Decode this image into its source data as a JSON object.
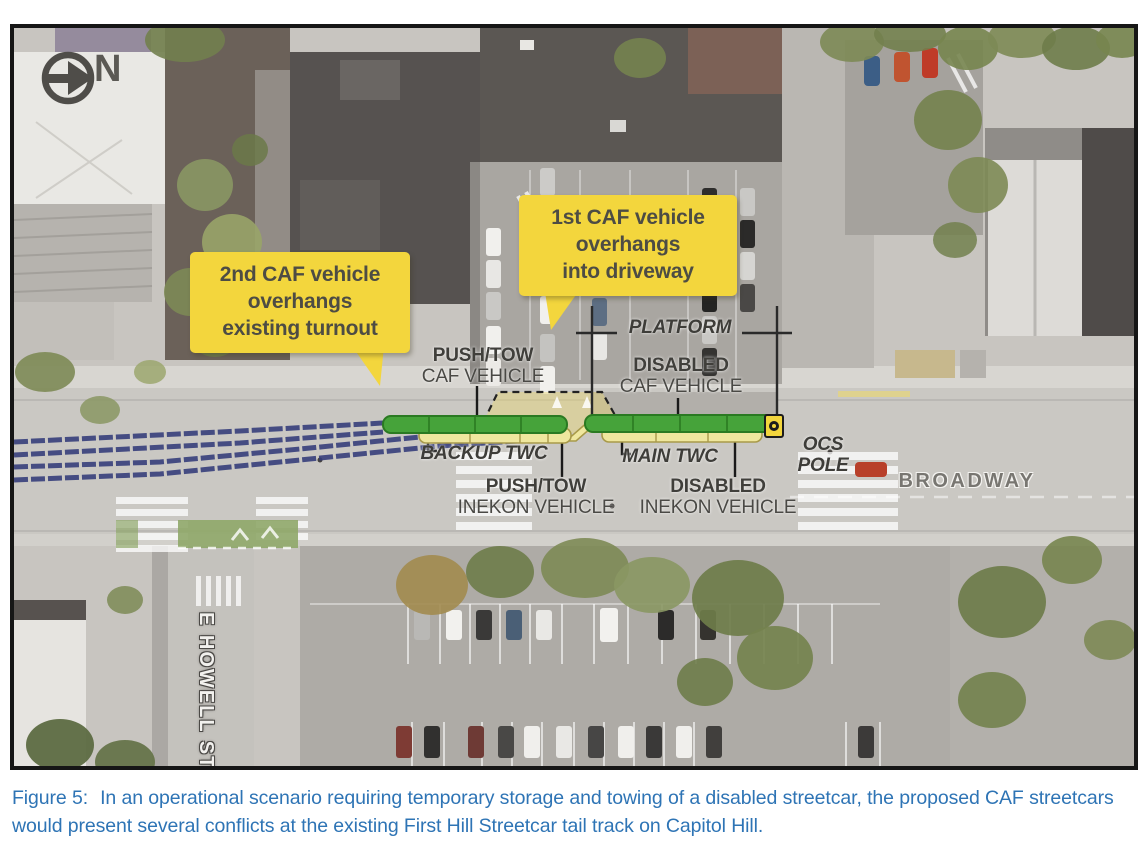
{
  "figure": {
    "caption": {
      "prefix": "Figure 5:",
      "text": "In an operational scenario requiring temporary storage and towing of a disabled streetcar, the proposed CAF streetcars would present several conflicts at the existing First Hill Streetcar tail track on Capitol Hill."
    }
  },
  "map": {
    "north": "N",
    "callouts": {
      "second_caf": "2nd CAF vehicle\noverhangs\nexisting turnout",
      "first_caf": "1st CAF vehicle\noverhangs\ninto driveway"
    },
    "labels": {
      "push_tow_caf_1": "PUSH/TOW",
      "push_tow_caf_2": "CAF VEHICLE",
      "disabled_caf_1": "DISABLED",
      "disabled_caf_2": "CAF VEHICLE",
      "platform": "PLATFORM",
      "backup_twc": "BACKUP TWC",
      "main_twc": "MAIN TWC",
      "push_tow_inekon_1": "PUSH/TOW",
      "push_tow_inekon_2": "INEKON VEHICLE",
      "disabled_inekon_1": "DISABLED",
      "disabled_inekon_2": "INEKON VEHICLE",
      "ocs_pole": "OCS\nPOLE",
      "broadway": "BROADWAY",
      "e_howell": "E HOWELL ST"
    },
    "colors": {
      "callout_bg": "#f3d63d",
      "caf_vehicle_green": "#46a33a",
      "inekon_vehicle_yellow": "#efe79e",
      "track_blue": "#333c7a",
      "ocs_marker_yellow": "#f3d63d",
      "caption_blue": "#2e74b5"
    }
  }
}
